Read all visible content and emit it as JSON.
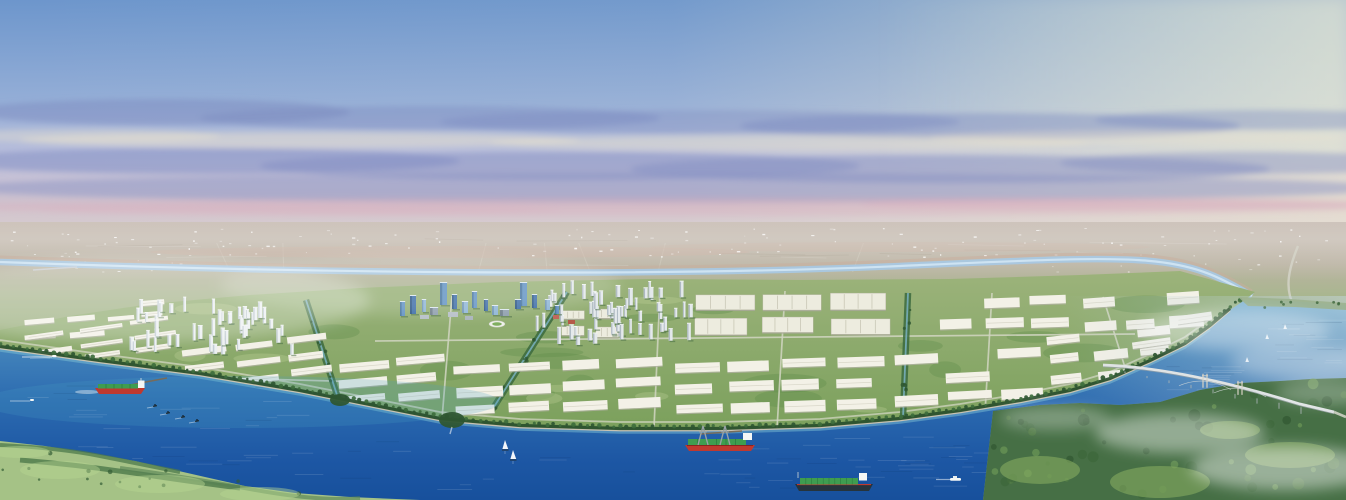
{
  "image": {
    "kind": "aerial-architectural-rendering",
    "description": "Panoramic aerial rendering of a riverside master-planned industrial park and township: white factory rows and residential towers on green land, a blue CBD cluster, a wide blue river with cargo ships and sailboats, a bridge over the river bend at right, forested hills in the foreground corners, hazy plain and pastel sky above.",
    "visible_text": "none"
  },
  "scene": {
    "colors": {
      "cb": "#7d8cc0",
      "cc": "#e9e2cf",
      "cd": "#8490c4",
      "pk": "#d8abbc",
      "mint": "#d6eadc",
      "cream": "#f0ead0",
      "farRiver": "#a7c9e4",
      "farRiverCore": "#d2e6f4",
      "sandFlat": "#c9ae9e",
      "roadLight": "#d2d6c2",
      "canalTree": "#3c6a3e",
      "canalWater": "#7db6c9",
      "barFill": "#f3f1e7",
      "barShade": "#b2b2a2",
      "barRidge": "#d9d7c9",
      "plantFill": "#edecdf",
      "plantRidge": "#c9c7b6",
      "plantShade": "#a8a899",
      "treeDark": "#2e5631",
      "treeMid": "#3d6d3c",
      "beach": "#d9cdb2",
      "embank": "#274d2b",
      "hillBase": "#a5c286",
      "hillRidge": "#4d7a4b",
      "hillDot": "#335c34",
      "hillLight": "#b9d693",
      "forestBase": "#466f45",
      "meadow": "#86ab61",
      "bankStrip": "#9cb28f",
      "shipRed": "#c0392f",
      "deckGreen": "#3f9d50",
      "deckLine": "#2c7a3e",
      "hullDark": "#26343c",
      "craneGray": "#98a3a6",
      "boatWhite": "#f5f7f5",
      "bridgeDeck": "#dfe3e4",
      "bridgeShade": "#98a2a8",
      "bridgePier": "#aab3b6",
      "bridgeTower": "#d8d3c6",
      "jetty": "#7d6a50"
    },
    "sky_stops": [
      [
        0,
        "#6d96cc"
      ],
      [
        0.42,
        "#96afd7"
      ],
      [
        0.6,
        "#b7bddb"
      ],
      [
        0.72,
        "#c8c2d5"
      ],
      [
        0.83,
        "#cfc0ca"
      ],
      [
        1,
        "#cdc3c7"
      ]
    ],
    "dist_stops": [
      [
        0,
        "#c6bab0"
      ],
      [
        0.35,
        "#bab3a2"
      ],
      [
        0.62,
        "#a9b68f"
      ],
      [
        1,
        "#94ad75"
      ]
    ],
    "land_stops": [
      [
        0,
        "#9cb37b"
      ],
      [
        1,
        "#7ba05c"
      ]
    ],
    "water_stops": [
      [
        0,
        "#7cb5d6"
      ],
      [
        0.22,
        "#4586bc"
      ],
      [
        0.5,
        "#2c6bb0"
      ],
      [
        0.8,
        "#1d57a4"
      ],
      [
        1,
        "#17509c"
      ]
    ],
    "clouds": [
      [
        160,
        112,
        190,
        13,
        "cb",
        0.5
      ],
      [
        430,
        118,
        230,
        12,
        "cb",
        0.45
      ],
      [
        700,
        122,
        260,
        12,
        "cb",
        0.4
      ],
      [
        990,
        126,
        250,
        13,
        "cb",
        0.45
      ],
      [
        1265,
        120,
        170,
        10,
        "cb",
        0.4
      ],
      [
        80,
        136,
        140,
        7,
        "cc",
        0.4
      ],
      [
        300,
        140,
        280,
        8,
        "cc",
        0.5
      ],
      [
        790,
        143,
        300,
        8,
        "cc",
        0.45
      ],
      [
        1140,
        138,
        210,
        7,
        "cc",
        0.4
      ],
      [
        200,
        161,
        260,
        13,
        "cd",
        0.55
      ],
      [
        560,
        166,
        300,
        14,
        "cd",
        0.5
      ],
      [
        950,
        169,
        320,
        14,
        "cd",
        0.5
      ],
      [
        1250,
        163,
        190,
        11,
        "cd",
        0.45
      ],
      [
        673,
        188,
        720,
        15,
        "cd",
        0.45
      ],
      [
        300,
        210,
        260,
        6,
        "pk",
        0.3
      ],
      [
        673,
        207,
        720,
        9,
        "pk",
        0.4
      ],
      [
        1120,
        204,
        260,
        6,
        "pk",
        0.45
      ]
    ],
    "far_river": {
      "path": "M0,262 C300,273 650,277 900,266 S1180,252 1252,296",
      "left_bridge": [
        33,
        270,
        77,
        267
      ],
      "highway": "M1298,246 C1289,268 1284,288 1294,306"
    },
    "top_edge": [
      [
        0,
        330
      ],
      [
        70,
        316
      ],
      [
        150,
        304
      ],
      [
        250,
        295
      ],
      [
        360,
        288
      ],
      [
        500,
        282
      ],
      [
        650,
        279
      ],
      [
        800,
        280
      ],
      [
        950,
        279
      ],
      [
        1080,
        275
      ],
      [
        1180,
        271
      ],
      [
        1255,
        292
      ],
      [
        1245,
        300
      ]
    ],
    "shoreline": [
      [
        0,
        348
      ],
      [
        100,
        362
      ],
      [
        200,
        375
      ],
      [
        300,
        392
      ],
      [
        380,
        408
      ],
      [
        440,
        420
      ],
      [
        520,
        427
      ],
      [
        620,
        430
      ],
      [
        720,
        430
      ],
      [
        820,
        427
      ],
      [
        900,
        420
      ],
      [
        960,
        412
      ],
      [
        1020,
        402
      ],
      [
        1070,
        392
      ],
      [
        1110,
        380
      ],
      [
        1150,
        362
      ],
      [
        1185,
        345
      ],
      [
        1210,
        327
      ],
      [
        1230,
        310
      ],
      [
        1245,
        300
      ]
    ],
    "far_bank": [
      [
        1290,
        301
      ],
      [
        1346,
        305
      ]
    ],
    "right_edge_water_bottom": 378,
    "forest_top": [
      [
        993,
        411
      ],
      [
        1040,
        405
      ],
      [
        1080,
        403
      ],
      [
        1120,
        405
      ],
      [
        1160,
        402
      ],
      [
        1200,
        390
      ],
      [
        1240,
        383
      ],
      [
        1280,
        381
      ],
      [
        1310,
        379
      ],
      [
        1346,
        378
      ]
    ],
    "forest_bottom": [
      [
        1346,
        500
      ],
      [
        983,
        500
      ]
    ],
    "hills": [
      [
        0,
        441
      ],
      [
        45,
        446
      ],
      [
        95,
        454
      ],
      [
        135,
        461
      ],
      [
        170,
        469
      ],
      [
        205,
        477
      ],
      [
        245,
        486
      ],
      [
        295,
        493
      ],
      [
        350,
        497
      ],
      [
        420,
        500
      ],
      [
        0,
        500
      ]
    ],
    "right_bank_strip": [
      [
        1238,
        297
      ],
      [
        1290,
        299
      ],
      [
        1346,
        303
      ],
      [
        1346,
        310
      ],
      [
        1295,
        307
      ],
      [
        1248,
        306
      ]
    ],
    "roads": [
      [
        375,
        341,
        1135,
        334
      ],
      [
        30,
        373,
        370,
        382
      ],
      [
        452,
        296,
        442,
        419
      ],
      [
        660,
        291,
        654,
        428
      ],
      [
        785,
        291,
        777,
        429
      ],
      [
        992,
        293,
        985,
        413
      ],
      [
        1103,
        297,
        1133,
        393
      ]
    ],
    "canals": [
      [
        306,
        300,
        338,
        398
      ],
      [
        567,
        292,
        492,
        410
      ],
      [
        908,
        293,
        903,
        418
      ]
    ],
    "bar_clusters": [
      {
        "x": 25,
        "y": 318,
        "w": 80,
        "h": 22,
        "rows": 2,
        "cols": 2,
        "rot": -5
      },
      {
        "x": 108,
        "y": 300,
        "w": 60,
        "h": 20,
        "rows": 2,
        "cols": 2,
        "rot": -5
      },
      {
        "x": 30,
        "y": 326,
        "w": 150,
        "h": 34,
        "rows": 3,
        "cols": 3,
        "rot": -8
      },
      {
        "x": 185,
        "y": 342,
        "w": 150,
        "h": 42,
        "rows": 3,
        "cols": 3,
        "rot": -7
      },
      {
        "x": 340,
        "y": 358,
        "w": 110,
        "h": 46,
        "rows": 3,
        "cols": 2,
        "rot": -5
      },
      {
        "x": 455,
        "y": 362,
        "w": 210,
        "h": 52,
        "rows": 3,
        "cols": 4,
        "rot": -3
      },
      {
        "x": 675,
        "y": 360,
        "w": 210,
        "h": 56,
        "rows": 3,
        "cols": 4,
        "rot": -2
      },
      {
        "x": 895,
        "y": 350,
        "w": 150,
        "h": 56,
        "rows": 3,
        "cols": 3,
        "rot": -3
      },
      {
        "x": 1050,
        "y": 330,
        "w": 130,
        "h": 52,
        "rows": 3,
        "cols": 3,
        "rot": -6
      },
      {
        "x": 940,
        "y": 298,
        "w": 130,
        "h": 34,
        "rows": 2,
        "cols": 3,
        "rot": -2
      },
      {
        "x": 1085,
        "y": 295,
        "w": 120,
        "h": 40,
        "rows": 2,
        "cols": 3,
        "rot": -4
      },
      {
        "x": 1130,
        "y": 318,
        "w": 90,
        "h": 30,
        "rows": 2,
        "cols": 2,
        "rot": -8
      }
    ],
    "plant_clusters": [
      {
        "x": 695,
        "y": 294,
        "w": 195,
        "h": 42,
        "rows": 2,
        "cols": 3
      },
      {
        "x": 562,
        "y": 310,
        "w": 58,
        "h": 28,
        "rows": 2,
        "cols": 2
      }
    ],
    "tower_clusters": [
      {
        "x": 122,
        "y": 303,
        "w": 175,
        "h": 52,
        "count": 46,
        "body": "#ecf0f2",
        "side": "#c2ccd3"
      },
      {
        "x": 528,
        "y": 287,
        "w": 165,
        "h": 58,
        "count": 60,
        "body": "#e4e9ec",
        "side": "#aeb9c2"
      }
    ],
    "cbd": {
      "body_palette": {
        "1": "#3f6fa8",
        "2": "#6293c3",
        "3": "#8fb6d6",
        "4": "#90a0ae"
      },
      "side_palette": {
        "1": "#2c5684",
        "2": "#47759e",
        "3": "#6f94b4",
        "4": "#6f7e8a"
      },
      "towers": [
        [
          400,
          302,
          5,
          14,
          "2"
        ],
        [
          410,
          296,
          6,
          18,
          "1"
        ],
        [
          422,
          300,
          4,
          12,
          "3"
        ],
        [
          440,
          283,
          7,
          22,
          "2"
        ],
        [
          452,
          295,
          5,
          14,
          "1"
        ],
        [
          462,
          302,
          6,
          11,
          "3"
        ],
        [
          472,
          292,
          5,
          16,
          "2"
        ],
        [
          484,
          300,
          4,
          11,
          "1"
        ],
        [
          492,
          306,
          6,
          9,
          "3"
        ],
        [
          520,
          283,
          7,
          23,
          "2"
        ],
        [
          532,
          295,
          5,
          13,
          "1"
        ],
        [
          545,
          300,
          5,
          10,
          "3"
        ],
        [
          555,
          306,
          4,
          8,
          "2"
        ],
        [
          430,
          308,
          8,
          7,
          "4"
        ],
        [
          500,
          310,
          9,
          6,
          "4"
        ],
        [
          515,
          300,
          6,
          9,
          "1"
        ]
      ],
      "podiums": [
        [
          448,
          312,
          10,
          5,
          "#b7bfc7"
        ],
        [
          465,
          316,
          8,
          4,
          "#aab4bc"
        ],
        [
          568,
          320,
          7,
          4,
          "#b55a49"
        ],
        [
          553,
          315,
          6,
          4,
          "#c0675a"
        ],
        [
          420,
          315,
          9,
          4,
          "#b7c0c8"
        ]
      ],
      "stadium": [
        497,
        324
      ]
    },
    "bridge": {
      "x1": 1103,
      "y1": 365,
      "x2": 1334,
      "y2": 412,
      "towers": [
        1205,
        1240
      ],
      "pier_start": 1125,
      "pier_end": 1320,
      "pier_step": 22
    },
    "ships": {
      "cargo_red": [
        95,
        380
      ],
      "crane_ship": [
        685,
        430
      ],
      "container_ship": [
        795,
        468
      ],
      "motorboat": [
        52,
        356
      ],
      "speedboat": [
        30,
        400
      ],
      "white_boat": [
        950,
        478
      ],
      "kayaks": [
        [
          155,
          406
        ],
        [
          168,
          413
        ],
        [
          183,
          417
        ],
        [
          197,
          421
        ]
      ],
      "sailboats": [
        [
          505,
          449
        ],
        [
          513,
          459
        ]
      ],
      "distant_sails": [
        [
          1267,
          339
        ],
        [
          1247,
          362
        ],
        [
          1285,
          329
        ]
      ],
      "jetties": [
        [
          130,
          385,
          167,
          378
        ],
        [
          700,
          434,
          742,
          431
        ]
      ]
    },
    "ripple_boxes": [
      [
        15,
        385,
        290,
        50
      ],
      [
        60,
        440,
        250,
        45
      ],
      [
        330,
        438,
        540,
        55
      ],
      [
        700,
        445,
        230,
        45
      ],
      [
        895,
        432,
        80,
        60
      ],
      [
        1255,
        315,
        80,
        55
      ],
      [
        1165,
        365,
        60,
        25
      ]
    ],
    "speck_count": 130
  }
}
